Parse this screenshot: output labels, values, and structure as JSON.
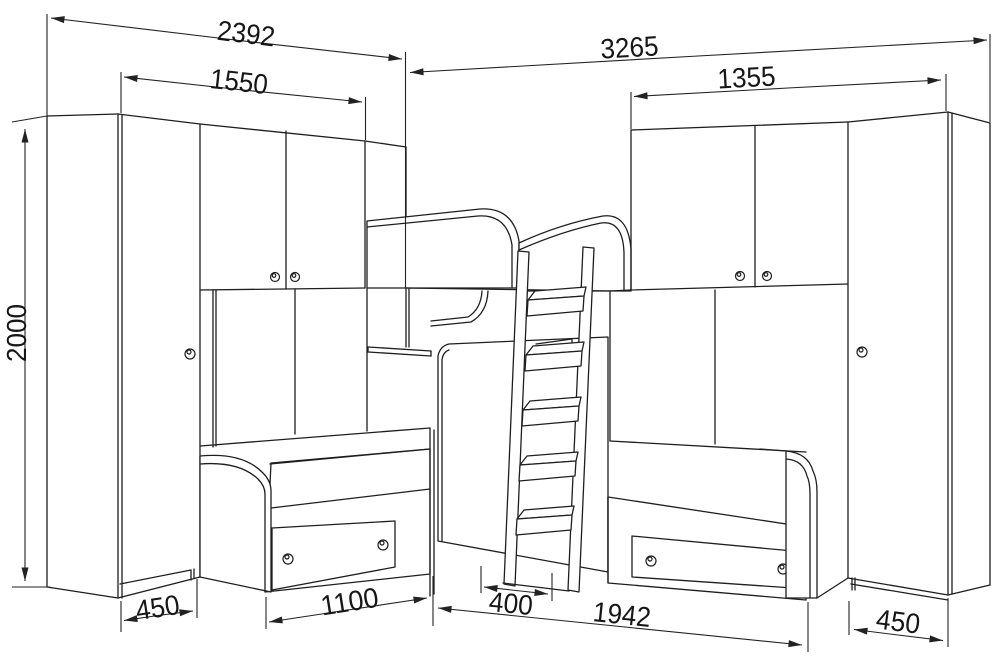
{
  "drawing": {
    "kind": "furniture-dimension-drawing",
    "background": "#ffffff",
    "line_color": "#1e1e1e"
  },
  "dimensions": {
    "overall_left_width": "2392",
    "overall_right_width": "3265",
    "left_cabinet_width": "1550",
    "right_cabinet_width": "1355",
    "overall_height": "2000",
    "left_wardrobe_width": "450",
    "left_bed_front": "1100",
    "ladder_footprint": "400",
    "right_bed_front": "1942",
    "right_wardrobe_width": "450"
  }
}
